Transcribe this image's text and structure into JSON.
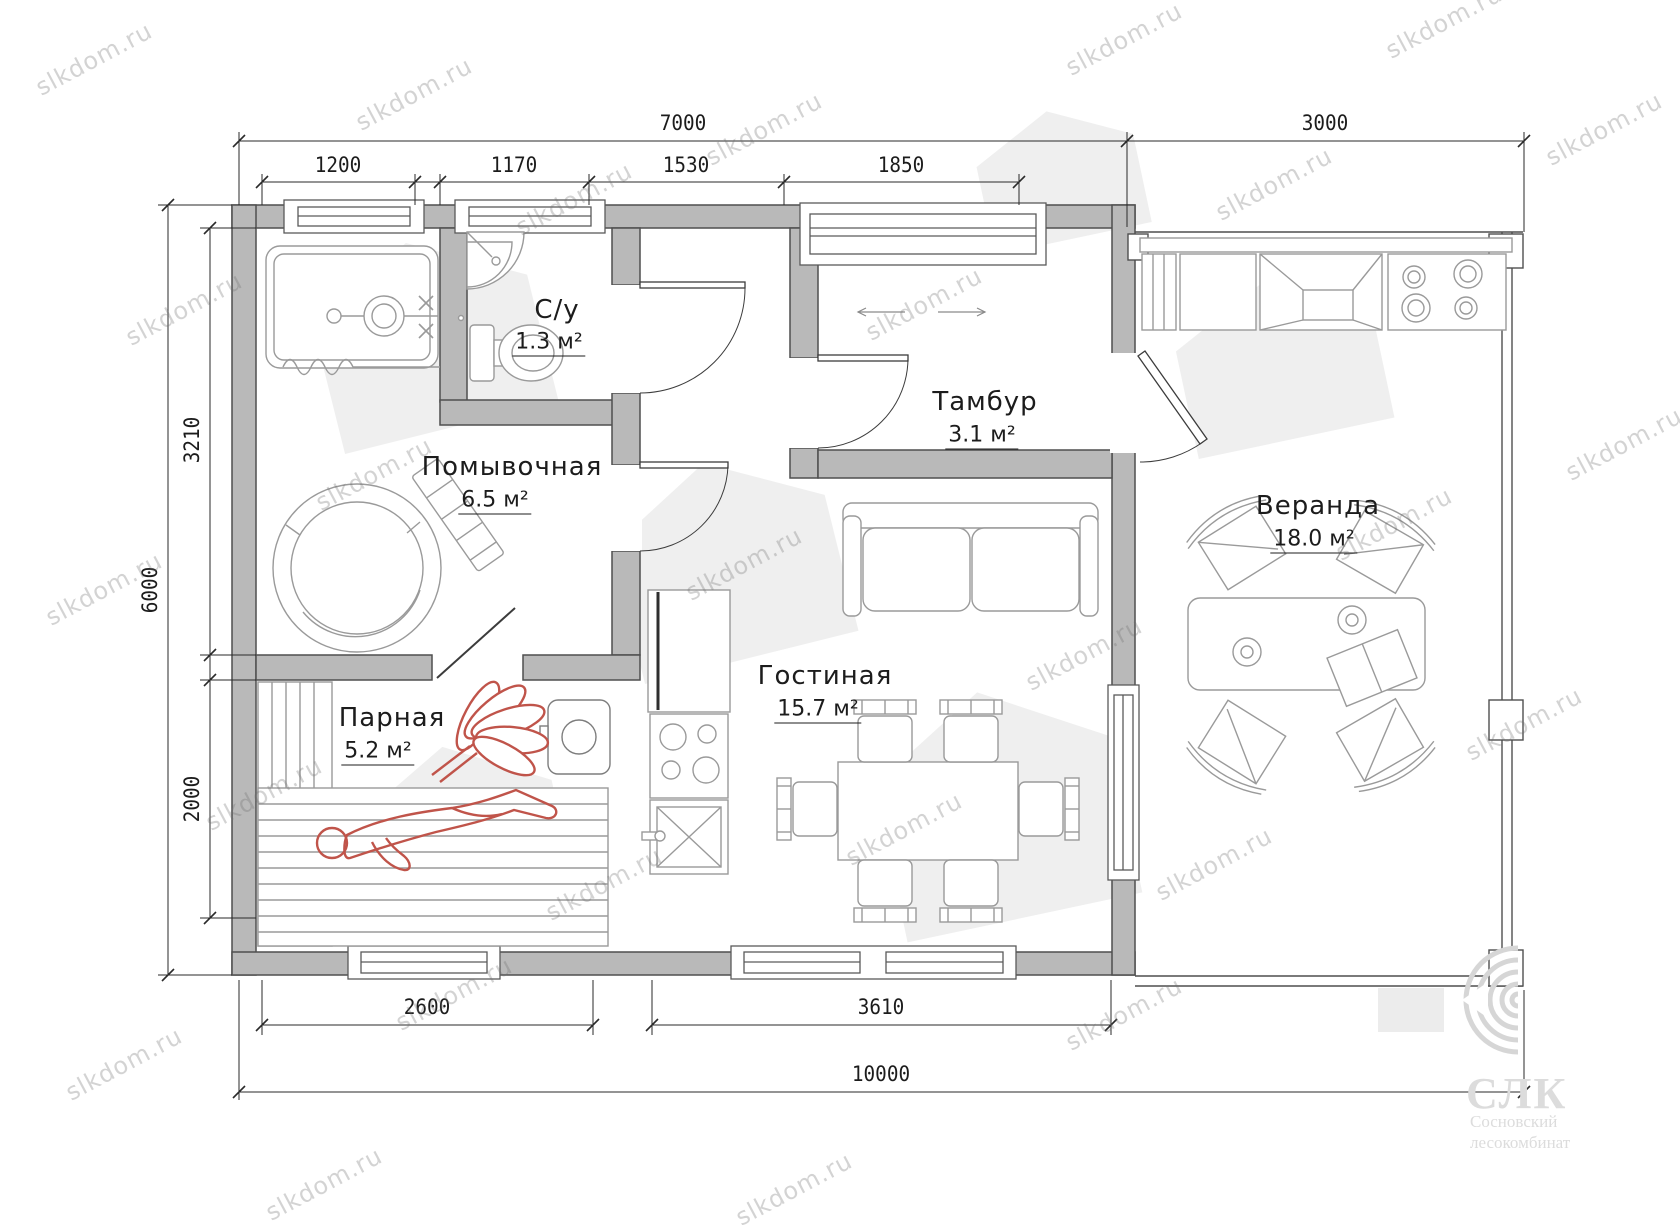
{
  "watermark": {
    "text": "slkdom.ru"
  },
  "logo": {
    "abbr": "СЛК",
    "line1": "Сосновский",
    "line2": "лесокомбинат"
  },
  "rooms": [
    {
      "name": "С/у",
      "area": "1.3 м²"
    },
    {
      "name": "Помывочная",
      "area": "6.5 м²"
    },
    {
      "name": "Тамбур",
      "area": "3.1 м²"
    },
    {
      "name": "Гостиная",
      "area": "15.7 м²"
    },
    {
      "name": "Парная",
      "area": "5.2 м²"
    },
    {
      "name": "Веранда",
      "area": "18.0 м²"
    }
  ],
  "dimensions": {
    "top_main": [
      "7000",
      "3000"
    ],
    "top_sub": [
      "1200",
      "1170",
      "1530",
      "1850"
    ],
    "left_outer": "6000",
    "left_inner": [
      "3210",
      "2000"
    ],
    "bottom_sub": [
      "2600",
      "3610"
    ],
    "bottom_total": "10000"
  },
  "colors": {
    "wall_fill": "#b9b9b9",
    "wall_stroke": "#4f4f4f",
    "furniture_stroke": "#9a9a9a",
    "figure_red": "#c0544a",
    "watermark_gray": "#bdbdbd"
  }
}
